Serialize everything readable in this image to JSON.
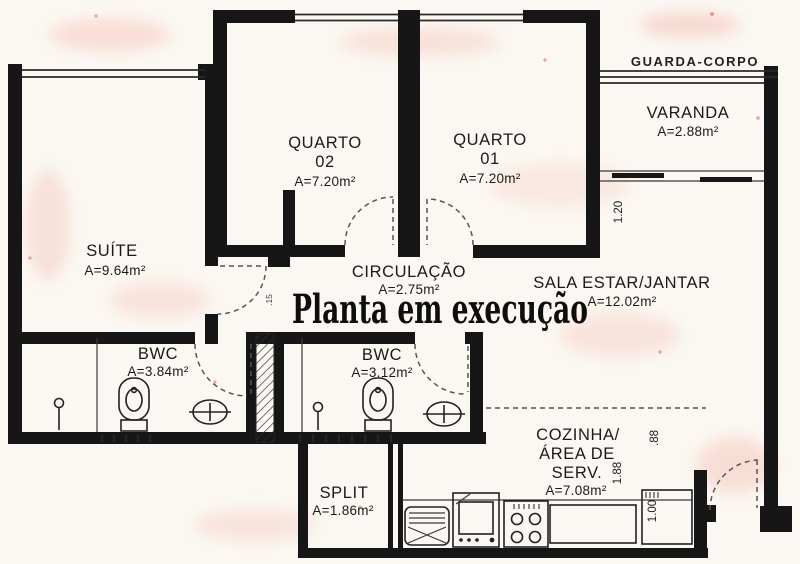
{
  "watermark": "Planta em execução",
  "labels": {
    "guarda_corpo": "GUARDA-CORPO"
  },
  "rooms": {
    "suite": {
      "name": "SUÍTE",
      "area": "A=9.64m²"
    },
    "quarto02": {
      "name": "QUARTO",
      "number": "02",
      "area": "A=7.20m²"
    },
    "quarto01": {
      "name": "QUARTO",
      "number": "01",
      "area": "A=7.20m²"
    },
    "varanda": {
      "name": "VARANDA",
      "area": "A=2.88m²"
    },
    "circulacao": {
      "name": "CIRCULAÇÃO",
      "area": "A=2.75m²"
    },
    "sala": {
      "name": "SALA ESTAR/JANTAR",
      "area": "A=12.02m²"
    },
    "bwc1": {
      "name": "BWC",
      "area": "A=3.84m²"
    },
    "bwc2": {
      "name": "BWC",
      "area": "A=3.12m²"
    },
    "split": {
      "name": "SPLIT",
      "area": "A=1.86m²"
    },
    "cozinha": {
      "line1": "COZINHA/",
      "line2": "ÁREA DE",
      "line3": "SERV.",
      "area": "A=7.08m²"
    }
  },
  "dimensions": {
    "varanda_offset": "1.20",
    "kitchen_d1": ".88",
    "kitchen_d2": "1.88",
    "kitchen_d3": "1.00",
    "wall_thickness": ".15"
  }
}
